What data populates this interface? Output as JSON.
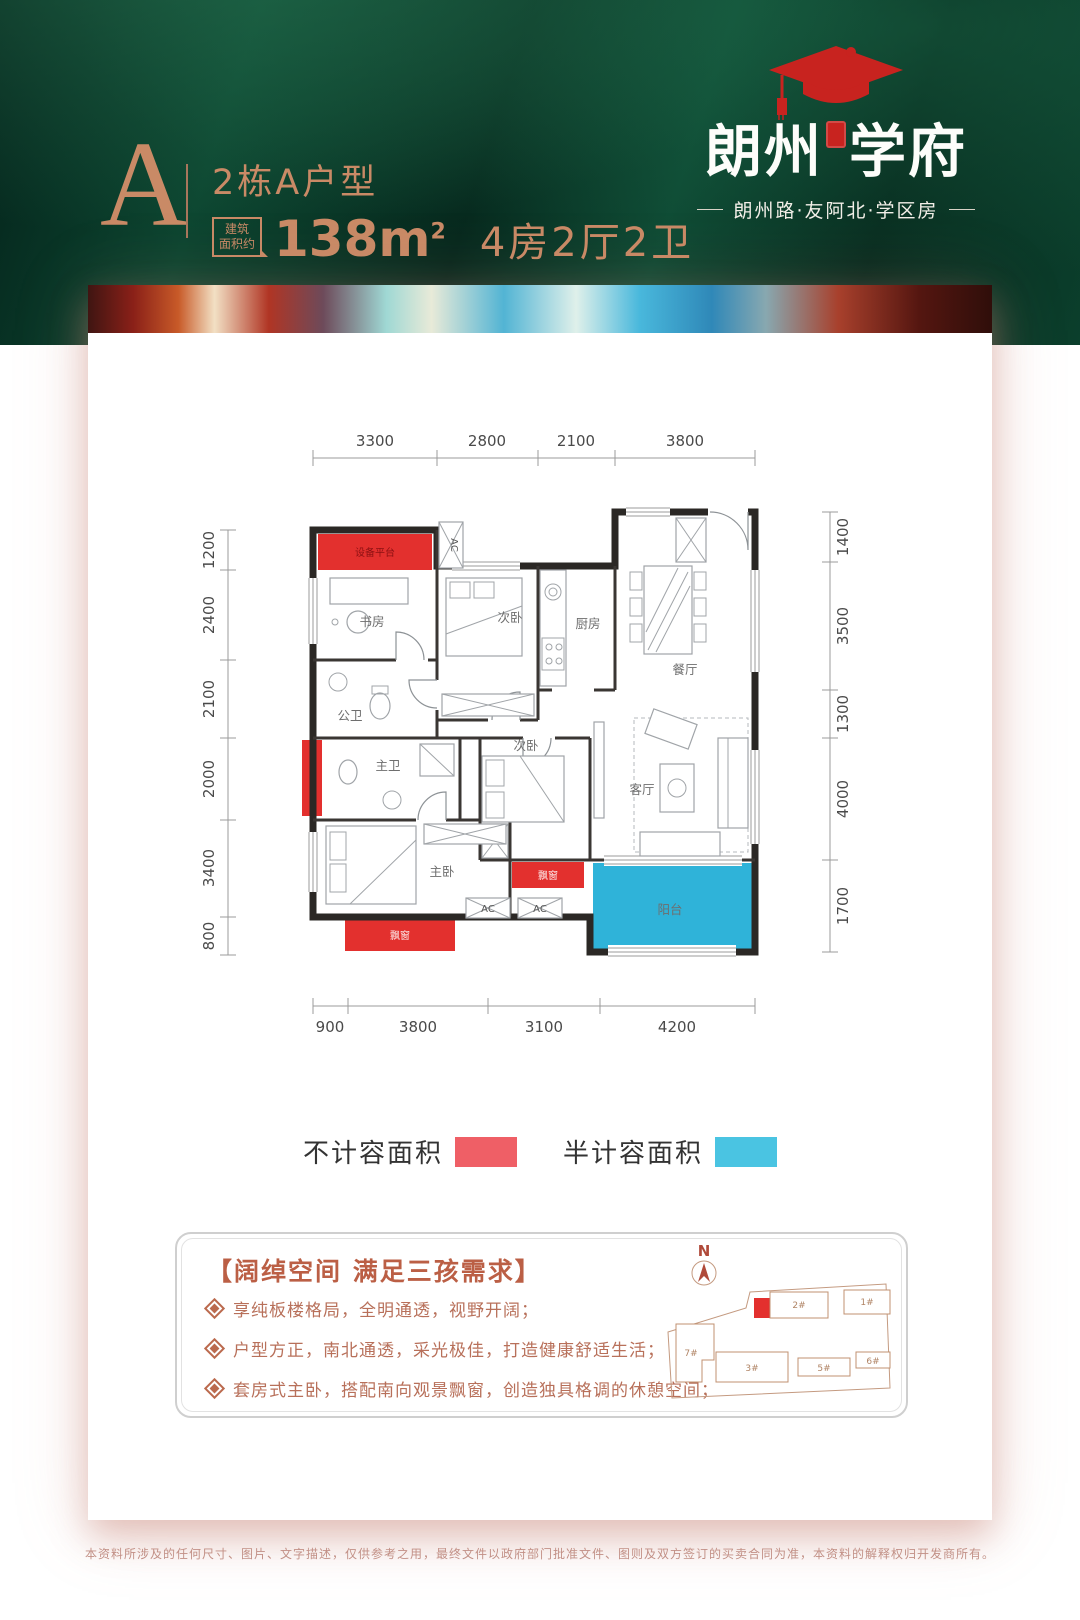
{
  "header": {
    "unit_letter": "A",
    "unit_title": "2栋A户型",
    "area_tag": {
      "line1": "建筑",
      "line2": "面积约"
    },
    "area_value": "138m",
    "area_unit_sup": "2",
    "layout_text": "4房2厅2卫",
    "brand": {
      "name_left": "朗州",
      "name_right": "学府",
      "tagline": "朗州路·友阿北·学区房",
      "cap_color": "#c8231f"
    }
  },
  "plan": {
    "dims_top": [
      "3300",
      "2800",
      "2100",
      "3800"
    ],
    "dims_bottom": [
      "900",
      "3800",
      "3100",
      "4200"
    ],
    "dims_left": [
      "1200",
      "2400",
      "2100",
      "2000",
      "3400",
      "800"
    ],
    "dims_right": [
      "1400",
      "3500",
      "1300",
      "4000",
      "1700"
    ],
    "labels": {
      "study": "书房",
      "bedroom2": "次卧",
      "kitchen": "厨房",
      "dining": "餐厅",
      "guest_bath": "公卫",
      "master_bath": "主卫",
      "master": "主卧",
      "bedroom3": "次卧",
      "living": "客厅",
      "balcony": "阳台",
      "platform": "设备平台",
      "bay1": "飘窗",
      "bay2": "飘窗",
      "ac": "AC"
    },
    "colors": {
      "no_count_area": "#e3302e",
      "half_count_area": "#2fb3d9"
    }
  },
  "legend": {
    "items": [
      {
        "label": "不计容面积",
        "color": "#ef5f66"
      },
      {
        "label": "半计容面积",
        "color": "#4ac4e2"
      }
    ]
  },
  "features": {
    "title": "【阔绰空间 满足三孩需求】",
    "bullets": [
      "享纯板楼格局，全明通透，视野开阔；",
      "户型方正，南北通透，采光极佳，打造健康舒适生活；",
      "套房式主卧，搭配南向观景飘窗，创造独具格调的休憩空间；"
    ]
  },
  "sitemap": {
    "north_label": "N",
    "buildings": [
      "2#",
      "1#",
      "7#",
      "3#",
      "5#",
      "6#"
    ]
  },
  "disclaimer": "本资料所涉及的任何尺寸、图片、文字描述，仅供参考之用，最终文件以政府部门批准文件、图则及双方签订的买卖合同为准，本资料的解释权归开发商所有。"
}
